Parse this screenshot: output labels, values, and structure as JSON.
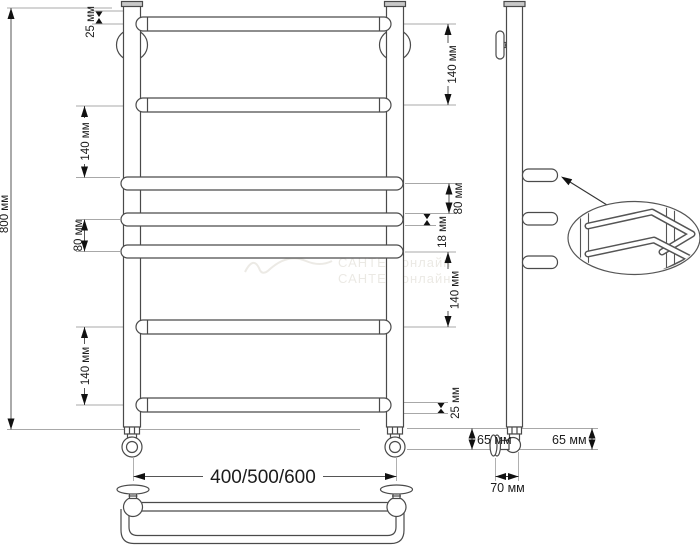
{
  "drawing": {
    "front_view": {
      "dim_overall_height": "800 мм",
      "dim_top_to_first_bar": "25 мм",
      "dim_left_upper_gap": "140 мм",
      "dim_left_middle_gap": "80 мм",
      "dim_left_lower_gap": "140 мм",
      "dim_right_upper_gap": "140 мм",
      "dim_right_hook_gap": "80 мм",
      "dim_hook_bar_thickness": "18 мм",
      "dim_right_lower_gap": "140 мм",
      "dim_last_bar_to_bottom": "25 мм",
      "dim_width_options": "400/500/600",
      "dim_bottom_fitting_height": "65 мм"
    },
    "side_view": {
      "dim_bottom_fitting_height": "65 мм",
      "dim_wall_offset": "70 мм"
    },
    "watermark": "САНТЕХ-онлайн"
  }
}
